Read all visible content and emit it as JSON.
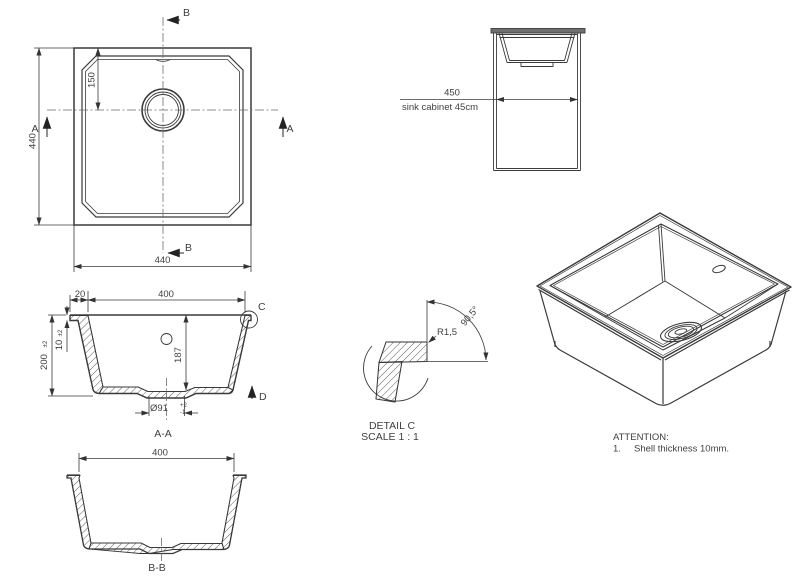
{
  "plan_view": {
    "section_b_top": "B",
    "section_b_bottom": "B",
    "section_a_left": "A",
    "section_a_right": "A",
    "dim_overall_height": "440",
    "dim_overall_width": "440",
    "dim_drain_from_top": "150"
  },
  "cabinet_view": {
    "dim_width": "450",
    "label": "sink cabinet 45cm"
  },
  "section_aa": {
    "title": "A-A",
    "dim_rim_overhang": "20",
    "dim_inner_width": "400",
    "dim_overall_depth": "200",
    "dim_overall_depth_tol": "±2",
    "dim_rim_thickness": "10",
    "dim_rim_thickness_tol": "±2",
    "dim_inner_depth": "187",
    "dim_drain_diameter": "Ø91",
    "dim_drain_tol_upper": "+2",
    "dim_drain_tol_lower": "-1",
    "detail_marker": "C",
    "view_arrow": "D"
  },
  "detail_c": {
    "title": "DETAIL C",
    "scale": "SCALE 1 : 1",
    "radius": "R1,5",
    "angle": "90,5°"
  },
  "section_bb": {
    "title": "B-B",
    "dim_inner_width": "400"
  },
  "attention": {
    "heading": "ATTENTION:",
    "item_number": "1.",
    "item_text": "Shell thickness 10mm."
  },
  "colors": {
    "line": "#3a3a3a",
    "thin_line": "#6b6b6b",
    "text": "#3f3f3f",
    "background": "#ffffff"
  }
}
